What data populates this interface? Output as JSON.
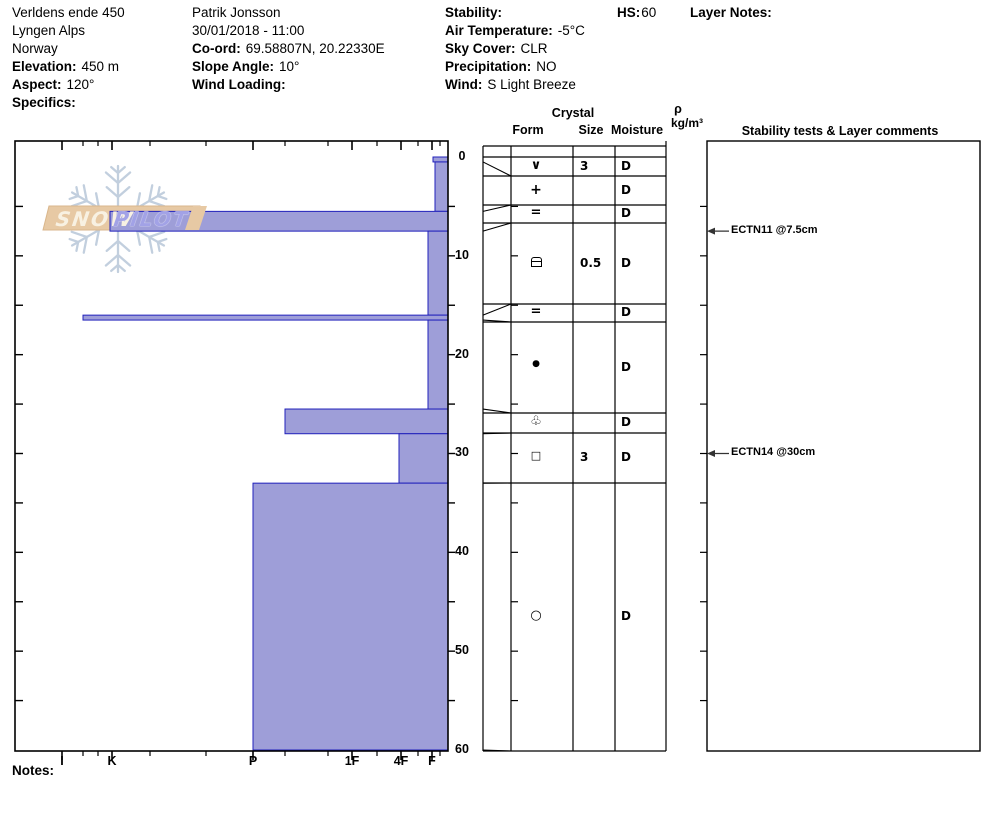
{
  "header": {
    "location": {
      "lines": [
        {
          "label": "",
          "value": "Verldens ende 450"
        },
        {
          "label": "",
          "value": "Lyngen Alps"
        },
        {
          "label": "",
          "value": "Norway"
        },
        {
          "label": "Elevation:",
          "value": "450 m"
        },
        {
          "label": "Aspect:",
          "value": "120°"
        },
        {
          "label": "Specifics:",
          "value": ""
        }
      ]
    },
    "observer": {
      "lines": [
        {
          "label": "",
          "value": "Patrik Jonsson"
        },
        {
          "label": "",
          "value": "30/01/2018 - 11:00"
        },
        {
          "label": "Co-ord:",
          "value": "69.58807N, 20.22330E"
        },
        {
          "label": "Slope Angle:",
          "value": "10°"
        },
        {
          "label": "Wind Loading:",
          "value": ""
        }
      ]
    },
    "conditions": {
      "lines": [
        {
          "label": "Stability:",
          "value": ""
        },
        {
          "label": "Air Temperature:",
          "value": "-5°C"
        },
        {
          "label": "Sky Cover:",
          "value": "CLR"
        },
        {
          "label": "Precipitation:",
          "value": "NO"
        },
        {
          "label": "Wind:",
          "value": "S Light Breeze"
        }
      ]
    },
    "hs_label": "HS:",
    "hs_value": "60",
    "layer_notes_label": "Layer Notes:"
  },
  "logo": {
    "word1": "SNOW",
    "word2": "PILOT"
  },
  "table_headers": {
    "crystal": "Crystal",
    "form": "Form",
    "size": "Size",
    "moisture": "Moisture",
    "rho": "ρ",
    "rho_unit": "kg/m³",
    "comments": "Stability tests & Layer comments"
  },
  "notes_label": "Notes:",
  "chart_data": {
    "type": "bar",
    "title": "Snow pit hardness profile (hardness vs depth)",
    "orientation": "horizontal-bars-from-right",
    "hardness_axis": {
      "categories": [
        "I",
        "K",
        "P",
        "1F",
        "4F",
        "F"
      ],
      "note": "hardest (I) at left, softest (F) at right"
    },
    "depth_axis": {
      "unit": "cm",
      "ticks": [
        0,
        10,
        20,
        30,
        40,
        50,
        60
      ],
      "range": [
        0,
        60
      ],
      "total_height_cm": 60
    },
    "layers": [
      {
        "top_cm": 0,
        "bottom_cm": 0.5,
        "hardness": "F-",
        "form": "∨",
        "form_name": "surface-hoar",
        "size_mm": "3",
        "moisture": "D"
      },
      {
        "top_cm": 0.5,
        "bottom_cm": 5.5,
        "hardness": "F",
        "form": "+",
        "form_name": "precipitation-particles",
        "size_mm": "",
        "moisture": "D"
      },
      {
        "top_cm": 5.5,
        "bottom_cm": 7.5,
        "hardness": "K",
        "form": "=",
        "form_name": "crust",
        "size_mm": "",
        "moisture": "D"
      },
      {
        "top_cm": 7.5,
        "bottom_cm": 16,
        "hardness": "F+",
        "form": "⊟",
        "form_name": "wind-packed",
        "size_mm": "0.5",
        "moisture": "D"
      },
      {
        "top_cm": 16,
        "bottom_cm": 16.5,
        "hardness": "I-K",
        "form": "=",
        "form_name": "crust",
        "size_mm": "",
        "moisture": "D"
      },
      {
        "top_cm": 16.5,
        "bottom_cm": 25.5,
        "hardness": "F+",
        "form": "●",
        "form_name": "rounded-grains",
        "size_mm": "",
        "moisture": "D"
      },
      {
        "top_cm": 25.5,
        "bottom_cm": 28,
        "hardness": "P-1F",
        "form": "♧",
        "form_name": "clustered-rounded-grains",
        "size_mm": "",
        "moisture": "D"
      },
      {
        "top_cm": 28,
        "bottom_cm": 33,
        "hardness": "4F",
        "form": "□",
        "form_name": "faceted-crystals",
        "size_mm": "3",
        "moisture": "D"
      },
      {
        "top_cm": 33,
        "bottom_cm": 60,
        "hardness": "P",
        "form": "○",
        "form_name": "melt-forms",
        "size_mm": "",
        "moisture": "D"
      }
    ],
    "annotations": [
      {
        "text": "ECTN11 @7.5cm",
        "depth_cm": 7.5
      },
      {
        "text": "ECTN14 @30cm",
        "depth_cm": 30
      }
    ],
    "bar_fill": "#9e9ed8",
    "bar_stroke": "#2121bb",
    "banner_fill": "#e7c9a4",
    "snowflake_color": "#bccadb"
  }
}
